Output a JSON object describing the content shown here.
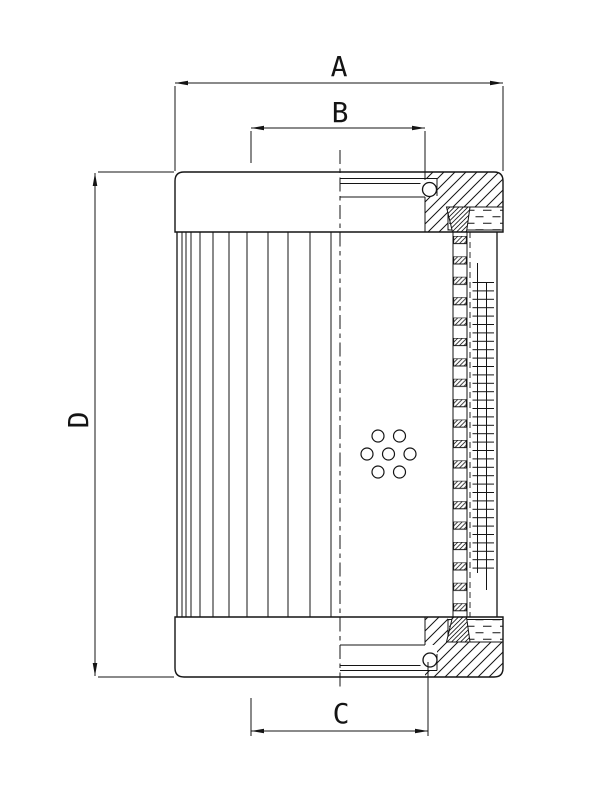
{
  "drawing": {
    "background_color": "#ffffff",
    "line_color": "#141414",
    "dimension_labels": {
      "a": "A",
      "b": "B",
      "c": "C",
      "d": "D"
    }
  }
}
